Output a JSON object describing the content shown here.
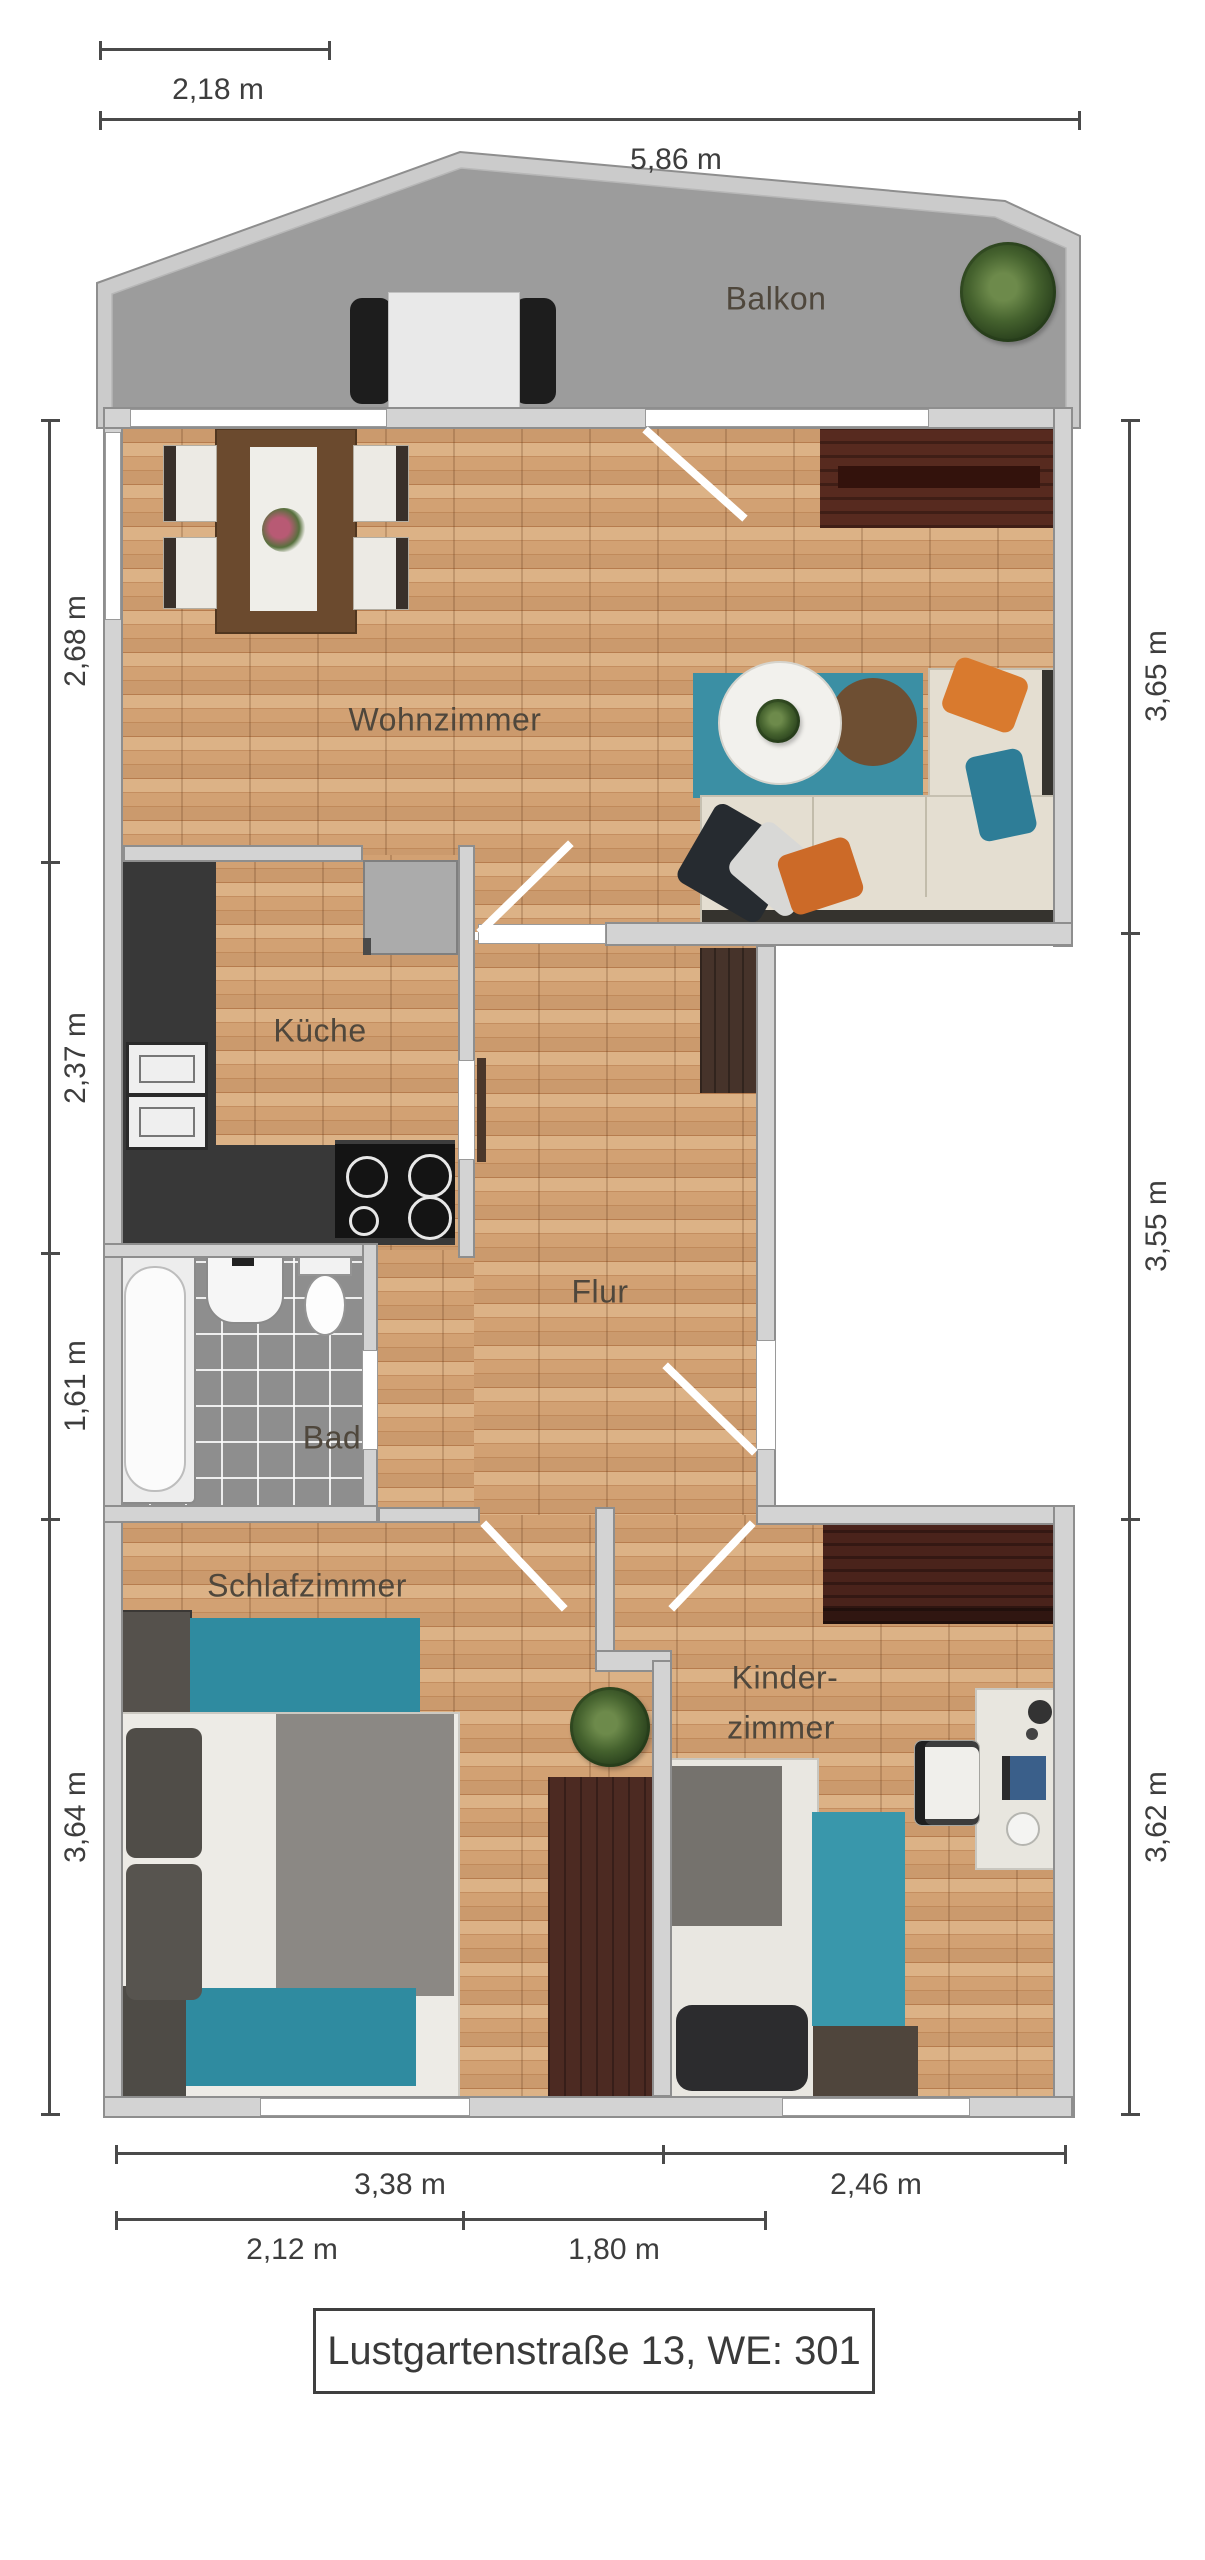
{
  "title": "Lustgartenstraße 13, WE: 301",
  "rooms": {
    "balcony": "Balkon",
    "living": "Wohnzimmer",
    "kitchen": "Küche",
    "hall": "Flur",
    "bath": "Bad",
    "bedroom": "Schlafzimmer",
    "kids_line1": "Kinder-",
    "kids_line2": "zimmer"
  },
  "dimensions": {
    "top": [
      "2,18 m",
      "5,86 m"
    ],
    "left": [
      "2,68 m",
      "2,37 m",
      "1,61 m",
      "3,64 m"
    ],
    "right": [
      "3,65 m",
      "3,55 m",
      "3,62 m"
    ],
    "bottom_row1": [
      "3,38 m",
      "2,46 m"
    ],
    "bottom_row2": [
      "2,12 m",
      "1,80 m"
    ]
  },
  "colors": {
    "wood": "#c6936a",
    "wall": "#d3d3d3",
    "balcony_floor": "#9c9c9c",
    "teal": "#3390a6",
    "tile": "#8e8e8e",
    "counter": "#383838",
    "dark_wood": "#4c2a22",
    "dim_line": "#4a4a4a"
  }
}
